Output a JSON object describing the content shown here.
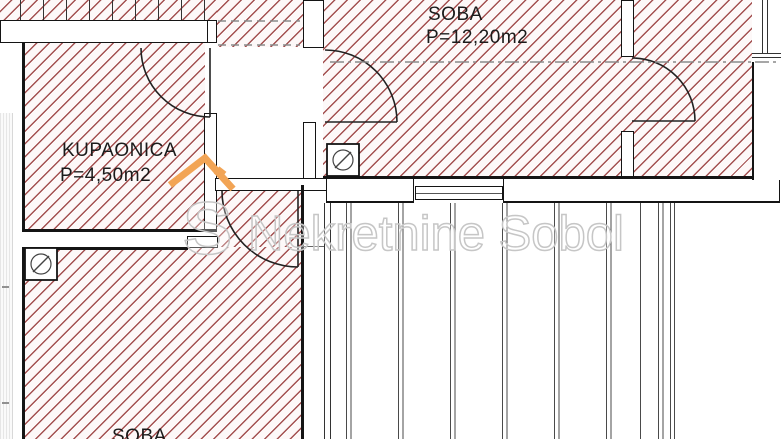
{
  "floorplan": {
    "rooms": [
      {
        "name": "KUPAONICA",
        "area": "P=4,50m2"
      },
      {
        "name": "SOBA",
        "area": "P=12,20m2"
      },
      {
        "name": "SOBA",
        "area": ""
      }
    ],
    "watermark": {
      "logo_letter": "S",
      "text": "Nekretnine Sobol"
    },
    "symbols": [
      {
        "name": "drain-symbol",
        "location": "top room wall"
      },
      {
        "name": "drain-symbol",
        "location": "bottom room corner"
      }
    ]
  },
  "colors": {
    "hatch_line": "#a35050",
    "hatch_bg": "#fdf8f8",
    "wall_line": "#141414",
    "wm_gray": "#c6c6c6",
    "logo_orange": "#f2a455",
    "dash_gray": "#8a8a8a"
  }
}
